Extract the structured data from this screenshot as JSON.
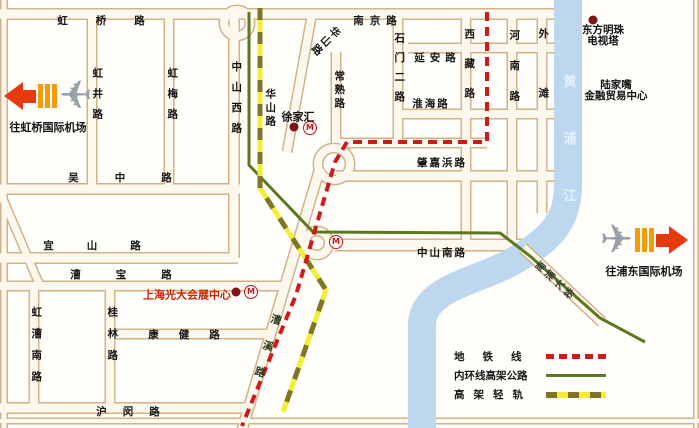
{
  "map": {
    "width": 699,
    "height": 428,
    "colors": {
      "road_border": "#d2b289",
      "road_fill": "#fdf8ee",
      "background": "#fffefb",
      "river": "#bcd7ee",
      "metro_red": "#cf1a1a",
      "ring_green": "#5c781d",
      "rail_yellow": "#f3ee35",
      "rail_olive": "#7f7524",
      "poi_dot": "#7c1315",
      "label_black": "#141414",
      "red_label": "#cc2200",
      "plane_gray": "#98a0a8",
      "arrow_red": "#e8380d",
      "arrow_orange": "#f59b0a"
    },
    "road_segments": [
      {
        "id": "left-frame",
        "x1": 4,
        "y1": 0,
        "x2": 4,
        "y2": 428,
        "w": 8
      },
      {
        "id": "right-frame",
        "x1": 696,
        "y1": 0,
        "x2": 696,
        "y2": 428,
        "w": 6
      },
      {
        "id": "bottom-frame",
        "x1": 0,
        "y1": 421,
        "x2": 699,
        "y2": 421,
        "w": 7
      },
      {
        "id": "hongqiao-nanjing-road",
        "x1": 0,
        "y1": 14,
        "x2": 554,
        "y2": 14,
        "w": 12
      },
      {
        "id": "yanan-road",
        "x1": 408,
        "y1": 48,
        "x2": 554,
        "y2": 48,
        "w": 11
      },
      {
        "id": "huaihai-road",
        "x1": 395,
        "y1": 114,
        "x2": 554,
        "y2": 114,
        "w": 11
      },
      {
        "id": "xujiahui-east-road",
        "x1": 340,
        "y1": 143,
        "x2": 487,
        "y2": 143,
        "w": 11
      },
      {
        "id": "zhaojiabang-road",
        "x1": 336,
        "y1": 176,
        "x2": 554,
        "y2": 176,
        "w": 12
      },
      {
        "id": "wuzhong-road",
        "x1": 0,
        "y1": 189,
        "x2": 240,
        "y2": 189,
        "w": 12
      },
      {
        "id": "yishan-road",
        "x1": 0,
        "y1": 258,
        "x2": 238,
        "y2": 258,
        "w": 12
      },
      {
        "id": "caobao-road",
        "x1": 0,
        "y1": 286,
        "x2": 282,
        "y2": 286,
        "w": 11
      },
      {
        "id": "kangjian-road",
        "x1": 110,
        "y1": 334,
        "x2": 268,
        "y2": 334,
        "w": 11
      },
      {
        "id": "humin-road",
        "x1": 0,
        "y1": 408,
        "x2": 252,
        "y2": 408,
        "w": 12
      },
      {
        "id": "zhongshan-south-road",
        "x1": 335,
        "y1": 245,
        "x2": 534,
        "y2": 245,
        "w": 13
      },
      {
        "id": "hongjing-road",
        "x1": 92,
        "y1": 14,
        "x2": 92,
        "y2": 189,
        "w": 11
      },
      {
        "id": "hongmei-road",
        "x1": 169,
        "y1": 14,
        "x2": 169,
        "y2": 189,
        "w": 11
      },
      {
        "id": "zhongshan-west-road",
        "x1": 234,
        "y1": 18,
        "x2": 234,
        "y2": 258,
        "w": 12
      },
      {
        "id": "changshu-road",
        "x1": 336,
        "y1": 52,
        "x2": 336,
        "y2": 143,
        "w": 11
      },
      {
        "id": "shimen-er-road",
        "x1": 398,
        "y1": 14,
        "x2": 398,
        "y2": 143,
        "w": 11
      },
      {
        "id": "xizang-road",
        "x1": 466,
        "y1": 14,
        "x2": 466,
        "y2": 245,
        "w": 11
      },
      {
        "id": "henan-road",
        "x1": 512,
        "y1": 14,
        "x2": 512,
        "y2": 245,
        "w": 11
      },
      {
        "id": "waitan-road",
        "x1": 542,
        "y1": 14,
        "x2": 542,
        "y2": 213,
        "w": 11
      },
      {
        "id": "hongcao-south-road",
        "x1": 34,
        "y1": 286,
        "x2": 34,
        "y2": 408,
        "w": 11
      },
      {
        "id": "guilin-road",
        "x1": 110,
        "y1": 286,
        "x2": 110,
        "y2": 408,
        "w": 11
      },
      {
        "id": "huashan-road",
        "x1": 312,
        "y1": 14,
        "x2": 287,
        "y2": 152,
        "w": 11
      },
      {
        "id": "caoxi-road",
        "x1": 320,
        "y1": 168,
        "x2": 242,
        "y2": 430,
        "w": 12
      },
      {
        "id": "left-diagonal-road",
        "x1": 0,
        "y1": 192,
        "x2": 40,
        "y2": 286,
        "w": 10
      }
    ],
    "circles": [
      {
        "id": "junction-top",
        "cx": 237,
        "cy": 23,
        "r": 13
      },
      {
        "id": "xujiahui-interchange",
        "cx": 334,
        "cy": 164,
        "r": 16
      },
      {
        "id": "south-interchange",
        "cx": 317,
        "cy": 243,
        "r": 12
      }
    ],
    "bridge_segment": {
      "id": "nanpu-bridge",
      "x1": 523,
      "y1": 248,
      "x2": 602,
      "y2": 322,
      "w": 12
    },
    "river": {
      "path": "M 568 -14 L 568 185 C 568 222 550 240 512 262 C 478 281 426 287 422 322 L 422 434",
      "width": 28,
      "label": {
        "id": "huangpu-river",
        "text": "黄浦江",
        "x": 568,
        "y": 138,
        "vertical": true,
        "spacing": 44,
        "size": 13,
        "color": "#e4f1fb"
      }
    },
    "lines": {
      "ring": {
        "points": "249,12 249,165 313,232 500,233 530,256 600,318 645,342",
        "width": 3
      },
      "rail": {
        "points": "260,8 260,188 326,290 283,412",
        "width": 5,
        "dash": "12 12"
      },
      "metro": {
        "points": "487,12 487,142 347,142 335,162 296,295 242,426",
        "width": 4,
        "dash": "9 6"
      }
    },
    "road_labels": [
      {
        "id": "hongqiao-road",
        "text": "虹桥路",
        "x": 101,
        "y": 21,
        "spacing": 28
      },
      {
        "id": "nanjing-road",
        "text": "南京路",
        "x": 375,
        "y": 21,
        "spacing": 6
      },
      {
        "id": "yanan-road",
        "text": "延安路",
        "x": 435,
        "y": 58,
        "spacing": 5
      },
      {
        "id": "huaihai-road",
        "text": "淮海路",
        "x": 430,
        "y": 104,
        "spacing": 2
      },
      {
        "id": "zhaojiabang-road",
        "text": "肇嘉浜路",
        "x": 441,
        "y": 163,
        "spacing": 2
      },
      {
        "id": "zhongshan-south-road",
        "text": "中山南路",
        "x": 441,
        "y": 253,
        "spacing": 2
      },
      {
        "id": "wuzhong-road",
        "text": "吴中路",
        "x": 120,
        "y": 178,
        "spacing": 36
      },
      {
        "id": "yishan-road",
        "text": "宜山路",
        "x": 92,
        "y": 246,
        "spacing": 33
      },
      {
        "id": "caobao-road",
        "text": "漕宝路",
        "x": 121,
        "y": 275,
        "spacing": 35
      },
      {
        "id": "kangjian-road",
        "text": "康健路",
        "x": 184,
        "y": 335,
        "spacing": 20
      },
      {
        "id": "humin-road",
        "text": "沪闵路",
        "x": 128,
        "y": 412,
        "spacing": 16
      },
      {
        "id": "hongjing-road",
        "text": "虹井路",
        "x": 97,
        "y": 93,
        "vertical": true,
        "spacing": 10
      },
      {
        "id": "hongmei-road",
        "text": "虹梅路",
        "x": 172,
        "y": 93,
        "vertical": true,
        "spacing": 10
      },
      {
        "id": "zhongshan-west-road",
        "text": "中山西路",
        "x": 236,
        "y": 97,
        "vertical": true,
        "spacing": 10
      },
      {
        "id": "huashan-road-upper",
        "text": "华山路",
        "x": 325,
        "y": 40,
        "vertical": true,
        "spacing": 2,
        "rotate": 45
      },
      {
        "id": "huashan-road-lower",
        "text": "华山路",
        "x": 270,
        "y": 107,
        "vertical": true,
        "spacing": 3
      },
      {
        "id": "changshu-road",
        "text": "常熟路",
        "x": 339,
        "y": 89,
        "vertical": true,
        "spacing": 3
      },
      {
        "id": "shimen-er-road",
        "text": "石门二路",
        "x": 399,
        "y": 67,
        "vertical": true,
        "spacing": 9
      },
      {
        "id": "xizang-road",
        "text": "西藏路",
        "x": 469,
        "y": 63,
        "vertical": true,
        "spacing": 19
      },
      {
        "id": "henan-road",
        "text": "河南路",
        "x": 514,
        "y": 65,
        "vertical": true,
        "spacing": 20
      },
      {
        "id": "waitan",
        "text": "外滩",
        "x": 543,
        "y": 63,
        "vertical": true,
        "spacing": 49
      },
      {
        "id": "hongcao-south-road",
        "text": "虹漕南路",
        "x": 36,
        "y": 344,
        "vertical": true,
        "spacing": 11
      },
      {
        "id": "guilin-road",
        "text": "桂林路",
        "x": 112,
        "y": 333,
        "vertical": true,
        "spacing": 11
      },
      {
        "id": "caoxi-road",
        "text": "漕溪路",
        "x": 265,
        "y": 345,
        "vertical": true,
        "spacing": 17,
        "rotate": 17,
        "color": "#2c3a1c"
      },
      {
        "id": "nanpu-bridge",
        "text": "南浦大桥",
        "x": 554,
        "y": 281,
        "vertical": true,
        "spacing": 3,
        "rotate": -47,
        "size": 10,
        "color": "#3a3a30"
      }
    ],
    "pois": [
      {
        "id": "xujiahui",
        "lines": [
          "徐家汇"
        ],
        "x": 298,
        "y": 117,
        "size": 11
      },
      {
        "id": "oriental-pearl-tower",
        "lines": [
          "东方明珠",
          "电视塔"
        ],
        "x": 603,
        "y": 36
      },
      {
        "id": "lujiazui-center",
        "lines": [
          "陆家嘴",
          "金融贸易中心"
        ],
        "x": 616,
        "y": 91
      },
      {
        "id": "everbright-center",
        "lines": [
          "上海光大会展中心"
        ],
        "x": 187,
        "y": 295,
        "size": 11,
        "color": "#cc2200"
      }
    ],
    "dots": [
      {
        "id": "xujiahui-dot",
        "x": 294,
        "y": 127
      },
      {
        "id": "oriental-pearl-dot",
        "x": 593,
        "y": 20
      },
      {
        "id": "everbright-dot",
        "x": 236,
        "y": 292
      }
    ],
    "stations": [
      {
        "id": "xujiahui-station",
        "x": 310,
        "y": 128,
        "label": "M"
      },
      {
        "id": "south-station",
        "x": 336,
        "y": 242,
        "label": "M"
      },
      {
        "id": "everbright-station",
        "x": 251,
        "y": 292,
        "label": "M"
      }
    ],
    "airports": {
      "left": {
        "label": "往虹桥国际机场"
      },
      "right": {
        "label": "往浦东国际机场"
      }
    },
    "legend": {
      "items": [
        {
          "label": "地铁线",
          "type": "metro"
        },
        {
          "label": "内环线高架公路",
          "type": "ring"
        },
        {
          "label": "高架轻轨",
          "type": "lightrail"
        }
      ]
    }
  }
}
